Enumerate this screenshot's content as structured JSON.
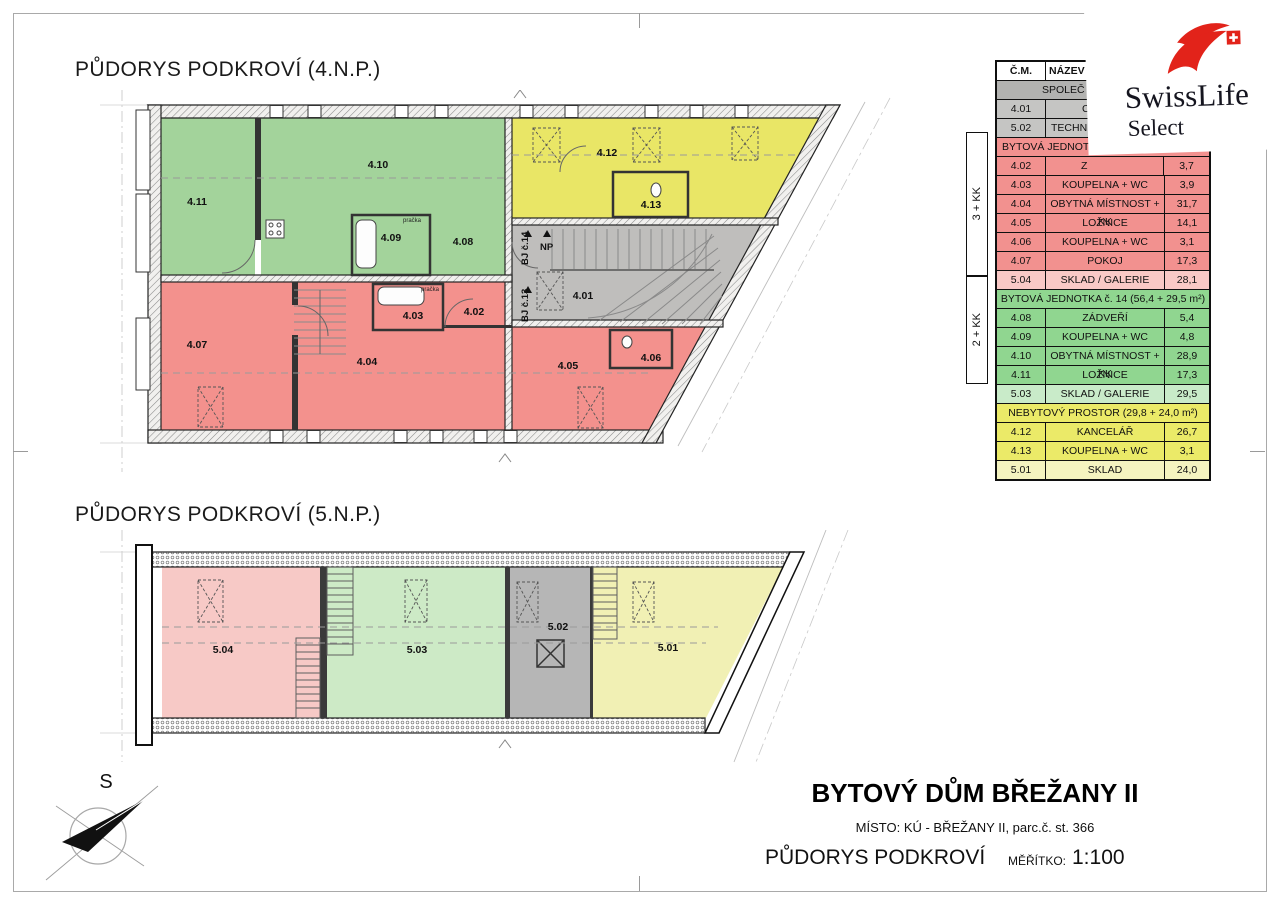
{
  "page": {
    "titles": {
      "plan4": "PŮDORYS PODKROVÍ (4.N.P.)",
      "plan5": "PŮDORYS PODKROVÍ (5.N.P.)"
    },
    "compass_label": "S"
  },
  "logo": {
    "brand": "SwissLife",
    "sub": "Select"
  },
  "plan4": {
    "rooms": {
      "r401": "4.01",
      "r402": "4.02",
      "r403": "4.03",
      "r404": "4.04",
      "r405": "4.05",
      "r406": "4.06",
      "r407": "4.07",
      "r408": "4.08",
      "r409": "4.09",
      "r410": "4.10",
      "r411": "4.11",
      "r412": "4.12",
      "r413": "4.13"
    },
    "annotations": {
      "bj14": "BJ č.14",
      "np": "NP",
      "bj13": "BJ č.13",
      "pracka": "pračka"
    }
  },
  "plan5": {
    "rooms": {
      "r501": "5.01",
      "r502": "5.02",
      "r503": "5.03",
      "r504": "5.04"
    }
  },
  "legend": {
    "header": {
      "num": "Č.M.",
      "name": "NÁZEV MÍ",
      "area": ""
    },
    "sections": [
      {
        "header": "SPOLEČ",
        "rows": [
          {
            "num": "4.01",
            "name": "C",
            "area": ""
          },
          {
            "num": "5.02",
            "name": "TECHNIC",
            "area": ""
          }
        ]
      },
      {
        "header": "BYTOVÁ JEDNOT",
        "side": "3 + KK",
        "rows": [
          {
            "num": "4.02",
            "name": "Z",
            "area": "3,7"
          },
          {
            "num": "4.03",
            "name": "KOUPELNA + WC",
            "area": "3,9"
          },
          {
            "num": "4.04",
            "name": "OBYTNÁ MÍSTNOST + KK",
            "area": "31,7"
          },
          {
            "num": "4.05",
            "name": "LOŽNICE",
            "area": "14,1"
          },
          {
            "num": "4.06",
            "name": "KOUPELNA + WC",
            "area": "3,1"
          },
          {
            "num": "4.07",
            "name": "POKOJ",
            "area": "17,3"
          },
          {
            "num": "5.04",
            "name": "SKLAD / GALERIE",
            "area": "28,1"
          }
        ]
      },
      {
        "header": "BYTOVÁ JEDNOTKA č. 14 (56,4 + 29,5 m²)",
        "side": "2 + KK",
        "rows": [
          {
            "num": "4.08",
            "name": "ZÁDVEŘÍ",
            "area": "5,4"
          },
          {
            "num": "4.09",
            "name": "KOUPELNA + WC",
            "area": "4,8"
          },
          {
            "num": "4.10",
            "name": "OBYTNÁ MÍSTNOST + KK",
            "area": "28,9"
          },
          {
            "num": "4.11",
            "name": "LOŽNICE",
            "area": "17,3"
          },
          {
            "num": "5.03",
            "name": "SKLAD / GALERIE",
            "area": "29,5"
          }
        ]
      },
      {
        "header": "NEBYTOVÝ PROSTOR (29,8 + 24,0 m²)",
        "rows": [
          {
            "num": "4.12",
            "name": "KANCELÁŘ",
            "area": "26,7"
          },
          {
            "num": "4.13",
            "name": "KOUPELNA + WC",
            "area": "3,1"
          },
          {
            "num": "5.01",
            "name": "SKLAD",
            "area": "24,0"
          }
        ]
      }
    ]
  },
  "title_block": {
    "project": "BYTOVÝ DŮM BŘEŽANY II",
    "location": "MÍSTO: KÚ - BŘEŽANY II, parc.č. st. 366",
    "drawing": "PŮDORYS PODKROVÍ",
    "scale_label": "MĚŘÍTKO:",
    "scale_value": "1:100"
  },
  "colors": {
    "table_gray": "#c5c5c3",
    "table_gray_header": "#b2b2b0",
    "table_red": "#f2918f",
    "table_red_light": "#f9c9c6",
    "table_green": "#90d690",
    "table_green_light": "#c9ebc9",
    "table_yellow": "#ebea68",
    "table_yellow_light": "#f4f3c0",
    "plan_green": "#a3d39b",
    "plan_yellow": "#e9e666",
    "plan_red": "#f3918d",
    "plan_gray": "#bfbebc",
    "plan_pink": "#f7c9c6",
    "plan_green_light": "#cdeac6",
    "plan_gray2": "#b6b6b6",
    "plan_yellow_light": "#f1f0b4",
    "logo_red": "#e2231a"
  }
}
